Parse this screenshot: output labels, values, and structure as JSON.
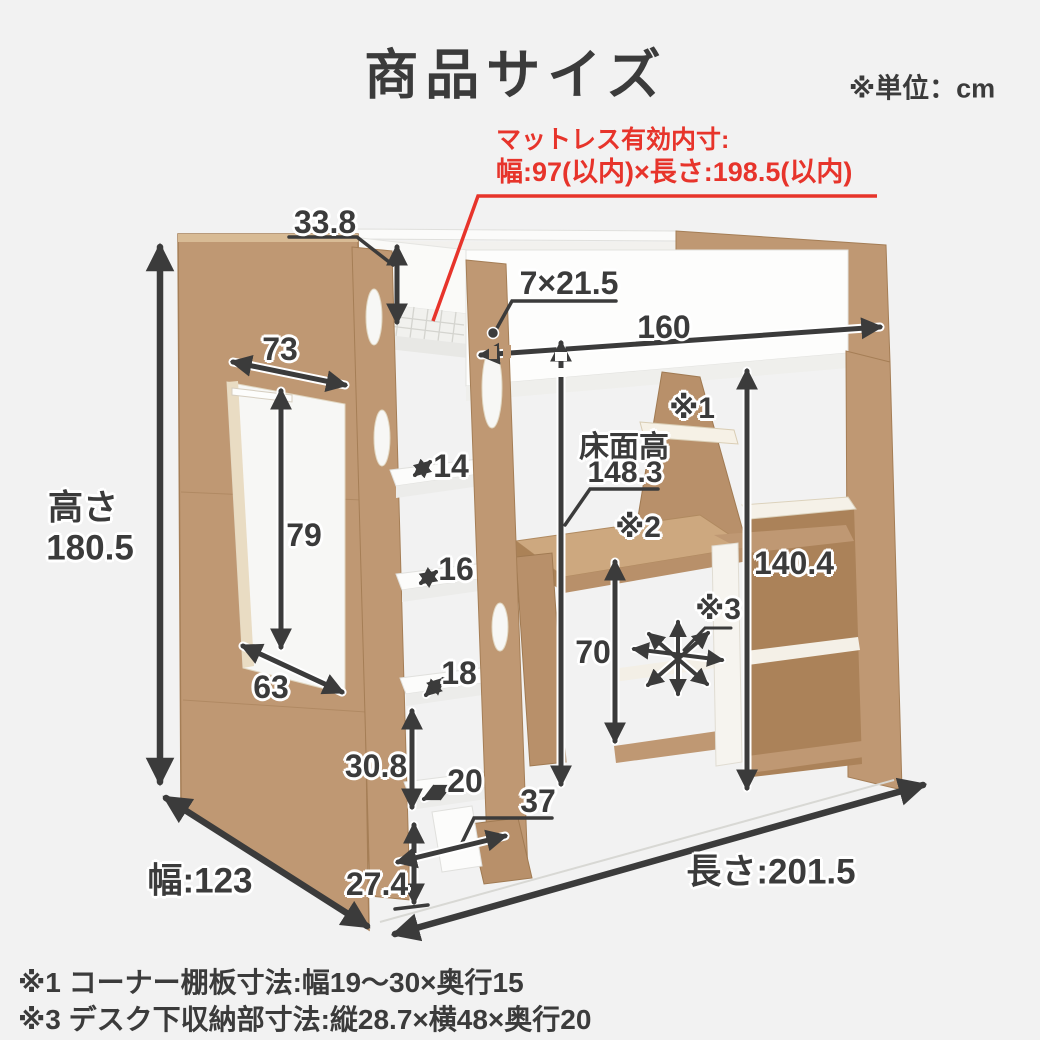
{
  "canvas": {
    "bg": "#f2f2f2",
    "ink": "#3b3b3b",
    "red": "#e7342b",
    "wood": "#bf9873"
  },
  "header": {
    "title": "商品サイズ",
    "unit_note": "※単位：cm"
  },
  "mattress_note": {
    "line1": "マットレス有効内寸:",
    "line2": "幅:97(以内)×長さ:198.5(以内)"
  },
  "dims": {
    "overall_height_label": "高さ",
    "overall_height": "180.5",
    "top_depth": "33.8",
    "opening_top_width": "73",
    "opening_height": "79",
    "opening_bottom_width": "63",
    "handle_cutout": "7×21.5",
    "fence_length": "160",
    "floor_height_label": "床面高",
    "floor_height": "148.3",
    "step_gap_1": "14",
    "step_gap_2": "16",
    "step_gap_3": "18",
    "step_gap_4": "20",
    "ladder_lower_height": "30.8",
    "ladder_bottom_height": "27.4",
    "ladder_foot_depth": "37",
    "under_bed_clearance": "140.4",
    "desk_height": "70",
    "overall_width_label": "幅:123",
    "overall_length_label": "長さ:201.5",
    "ref1": "※1",
    "ref2": "※2",
    "ref3": "※3"
  },
  "footnotes": {
    "note1": "※1 コーナー棚板寸法:幅19～30×奥行15",
    "note2": "※3 デスク下収納部寸法:縦28.7×横48×奥行20"
  }
}
